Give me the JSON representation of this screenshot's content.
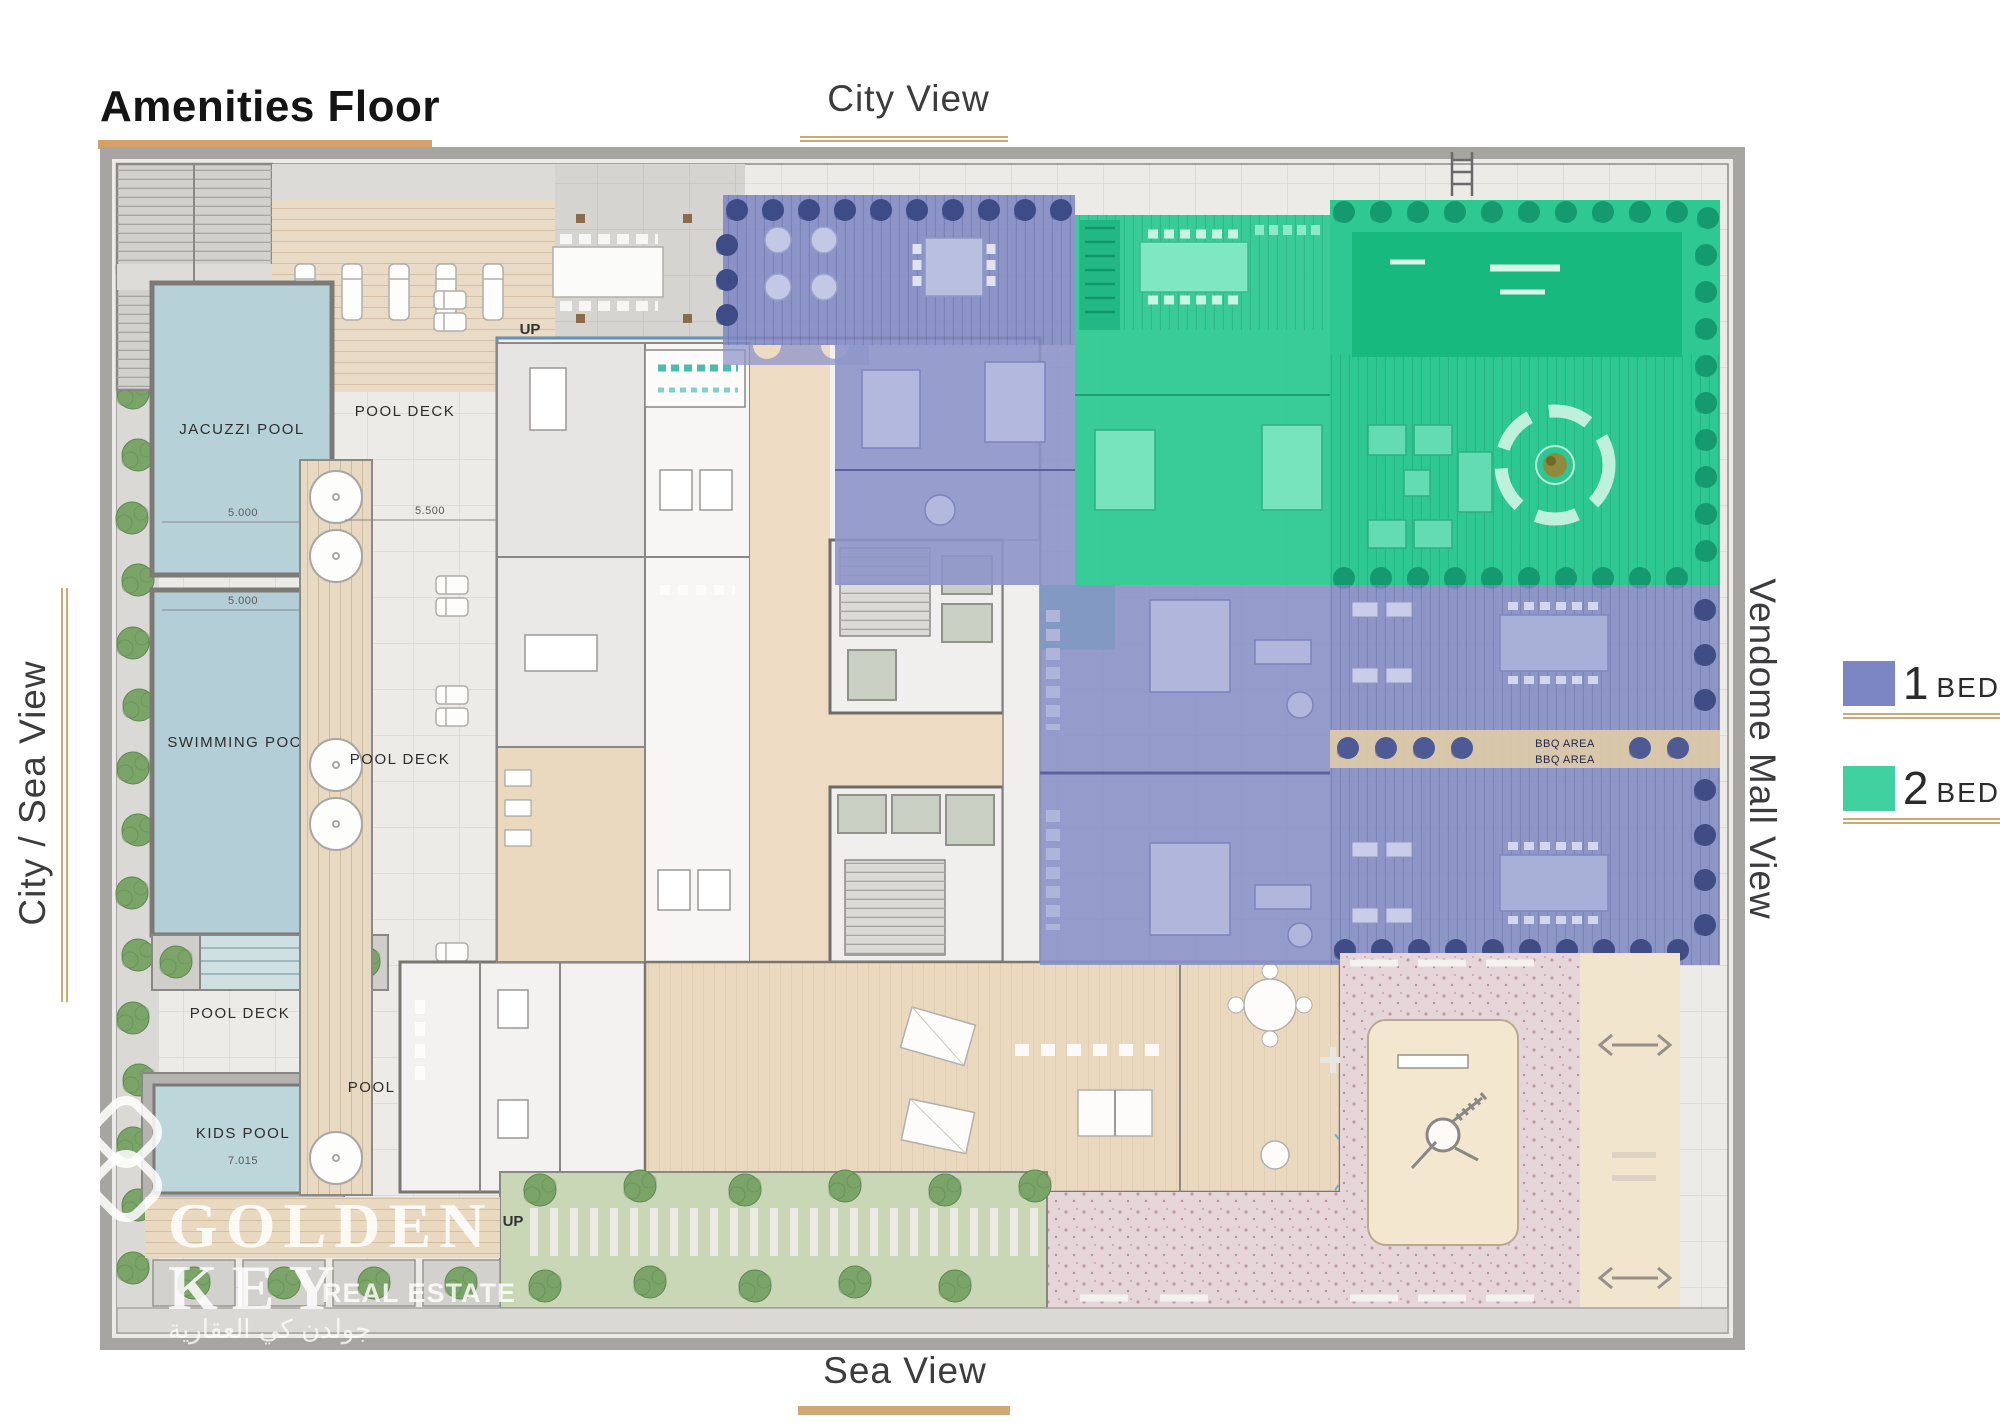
{
  "page": {
    "title": "Amenities Floor"
  },
  "views": {
    "top": "City View",
    "bottom": "Sea View",
    "left": "City / Sea View",
    "right": "Vendome Mall View"
  },
  "legend": {
    "items": [
      {
        "num": "1",
        "unit": "BED",
        "color": "#7B86C3"
      },
      {
        "num": "2",
        "unit": "BED",
        "color": "#41D1A1"
      }
    ]
  },
  "plan": {
    "labels": {
      "jacuzzi": "JACUZZI POOL",
      "swimming": "SWIMMING POOL",
      "kids": "KIDS POOL",
      "pool_deck": "POOL DECK",
      "up": "UP",
      "bbq": "BBQ AREA"
    },
    "dims": {
      "jacuzzi_width": "5.000",
      "swimming_width": "5.000",
      "deck_width": "5.500",
      "kids_width": "7.015"
    }
  },
  "watermark": {
    "line1": "GOLDEN",
    "line2": "KEY",
    "line3": "REAL ESTATE",
    "arabic": "جولدن كي العقارية"
  },
  "colors": {
    "accent_gold": "#CFA873",
    "one_bed": "#7B86C3",
    "two_bed": "#41D1A1"
  }
}
